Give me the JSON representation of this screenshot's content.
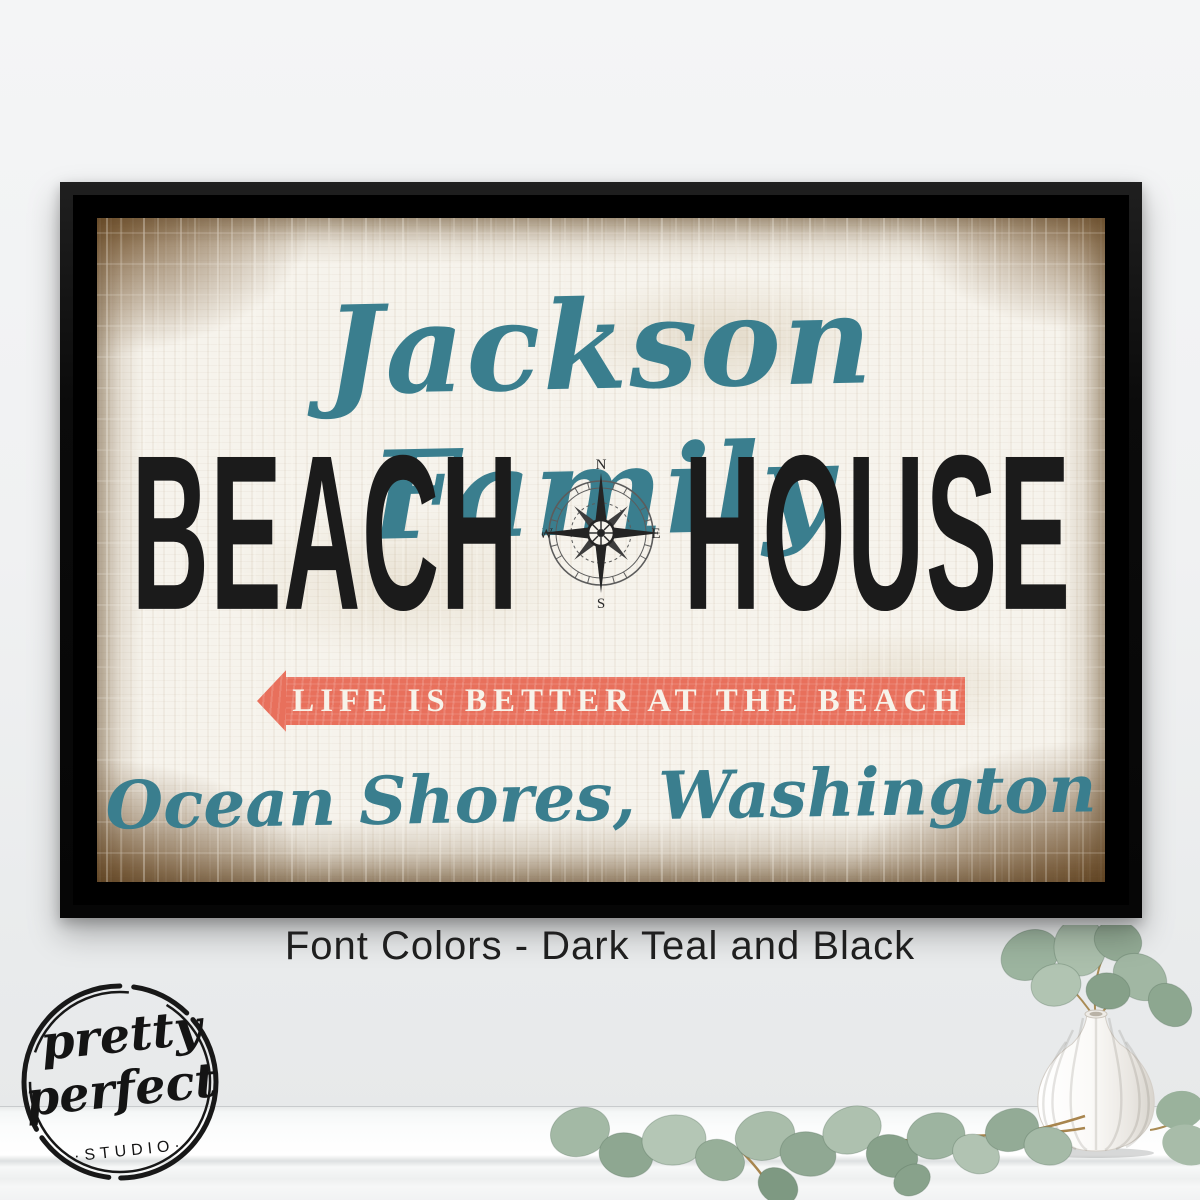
{
  "sign": {
    "family_name": "Jackson Family",
    "title_left": "BEACH",
    "title_right": "HOUSE",
    "compass": {
      "north": "N",
      "east": "E",
      "south": "S",
      "west": "W"
    },
    "banner_text": "LIFE IS BETTER AT THE BEACH",
    "location": "Ocean Shores, Washington"
  },
  "caption": {
    "text": "Font Colors - Dark Teal and Black"
  },
  "logo": {
    "word1": "pretty",
    "word2": "perfect",
    "studio": "·STUDIO·"
  },
  "icons": {
    "compass": "compass-rose-icon",
    "arrow": "left-arrow-icon"
  },
  "colors": {
    "teal": "#3a7e8e",
    "coral": "#e8705c",
    "ink": "#1b1b1b",
    "canvas": "#f6f3ec",
    "brown": "#7c5a33"
  }
}
